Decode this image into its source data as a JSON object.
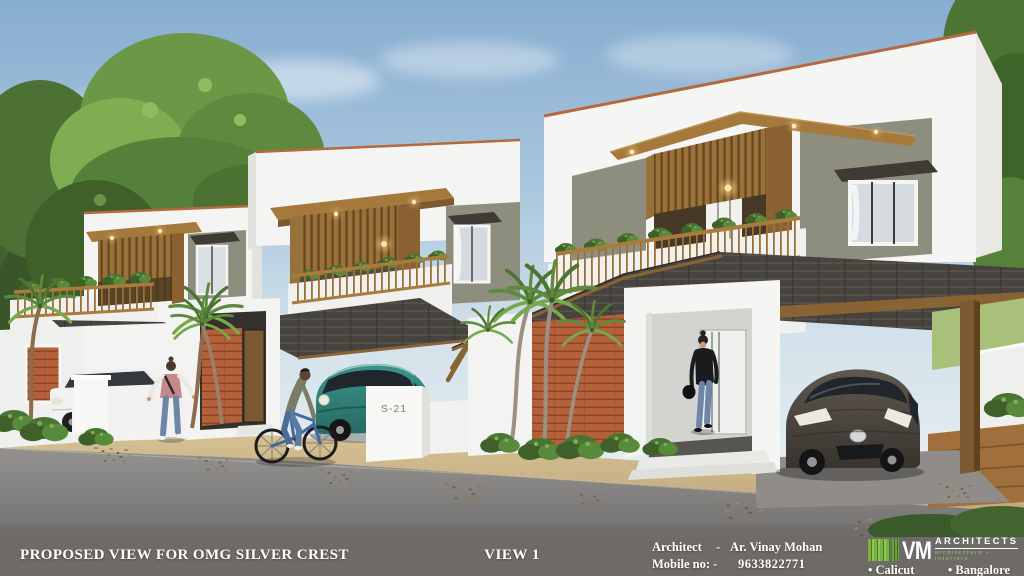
{
  "scene": {
    "description": "Photorealistic 3D exterior rendering of three modern two-storey white villas with wooden balcony canopies, dark pitched porch roofs, terracotta slat accent walls, palms, a teal hatchback, a dark hatchback, a white sedan, a cyclist and two pedestrians on a gray road",
    "gate_plate": "S-21"
  },
  "footer": {
    "project_title": "PROPOSED VIEW FOR OMG SILVER CREST",
    "view_label": "VIEW 1",
    "architect_label": "Architect",
    "architect_dash": "-",
    "architect_name": "Ar. Vinay Mohan",
    "mobile_label": "Mobile no: -",
    "mobile_number": "9633822771",
    "logo": {
      "initials": "VM",
      "name": "ARCHITECTS",
      "tagline": "architecture • interiors",
      "location_1": "• Calicut",
      "location_2": "• Bangalore"
    }
  },
  "palette": {
    "sky_top": "#87add0",
    "sky_horizon": "#eef3f5",
    "foliage_dark": "#3f6129",
    "foliage_light": "#76a94c",
    "wall_white": "#f4f4f2",
    "wall_olive": "#8e8e7e",
    "wood_brown": "#a5793b",
    "wood_dark": "#5f431f",
    "roof_dark": "#494540",
    "brick_terracotta": "#b4603a",
    "coping_terracotta": "#b5693e",
    "road_gray": "#8f8c89",
    "sand_tan": "#d0ba8c",
    "car_teal": "#2f7c72",
    "car_dark": "#4a443d",
    "car_white": "#f1f3f3",
    "footer_bar": "#6e6a67",
    "logo_green": "#79b33f"
  }
}
